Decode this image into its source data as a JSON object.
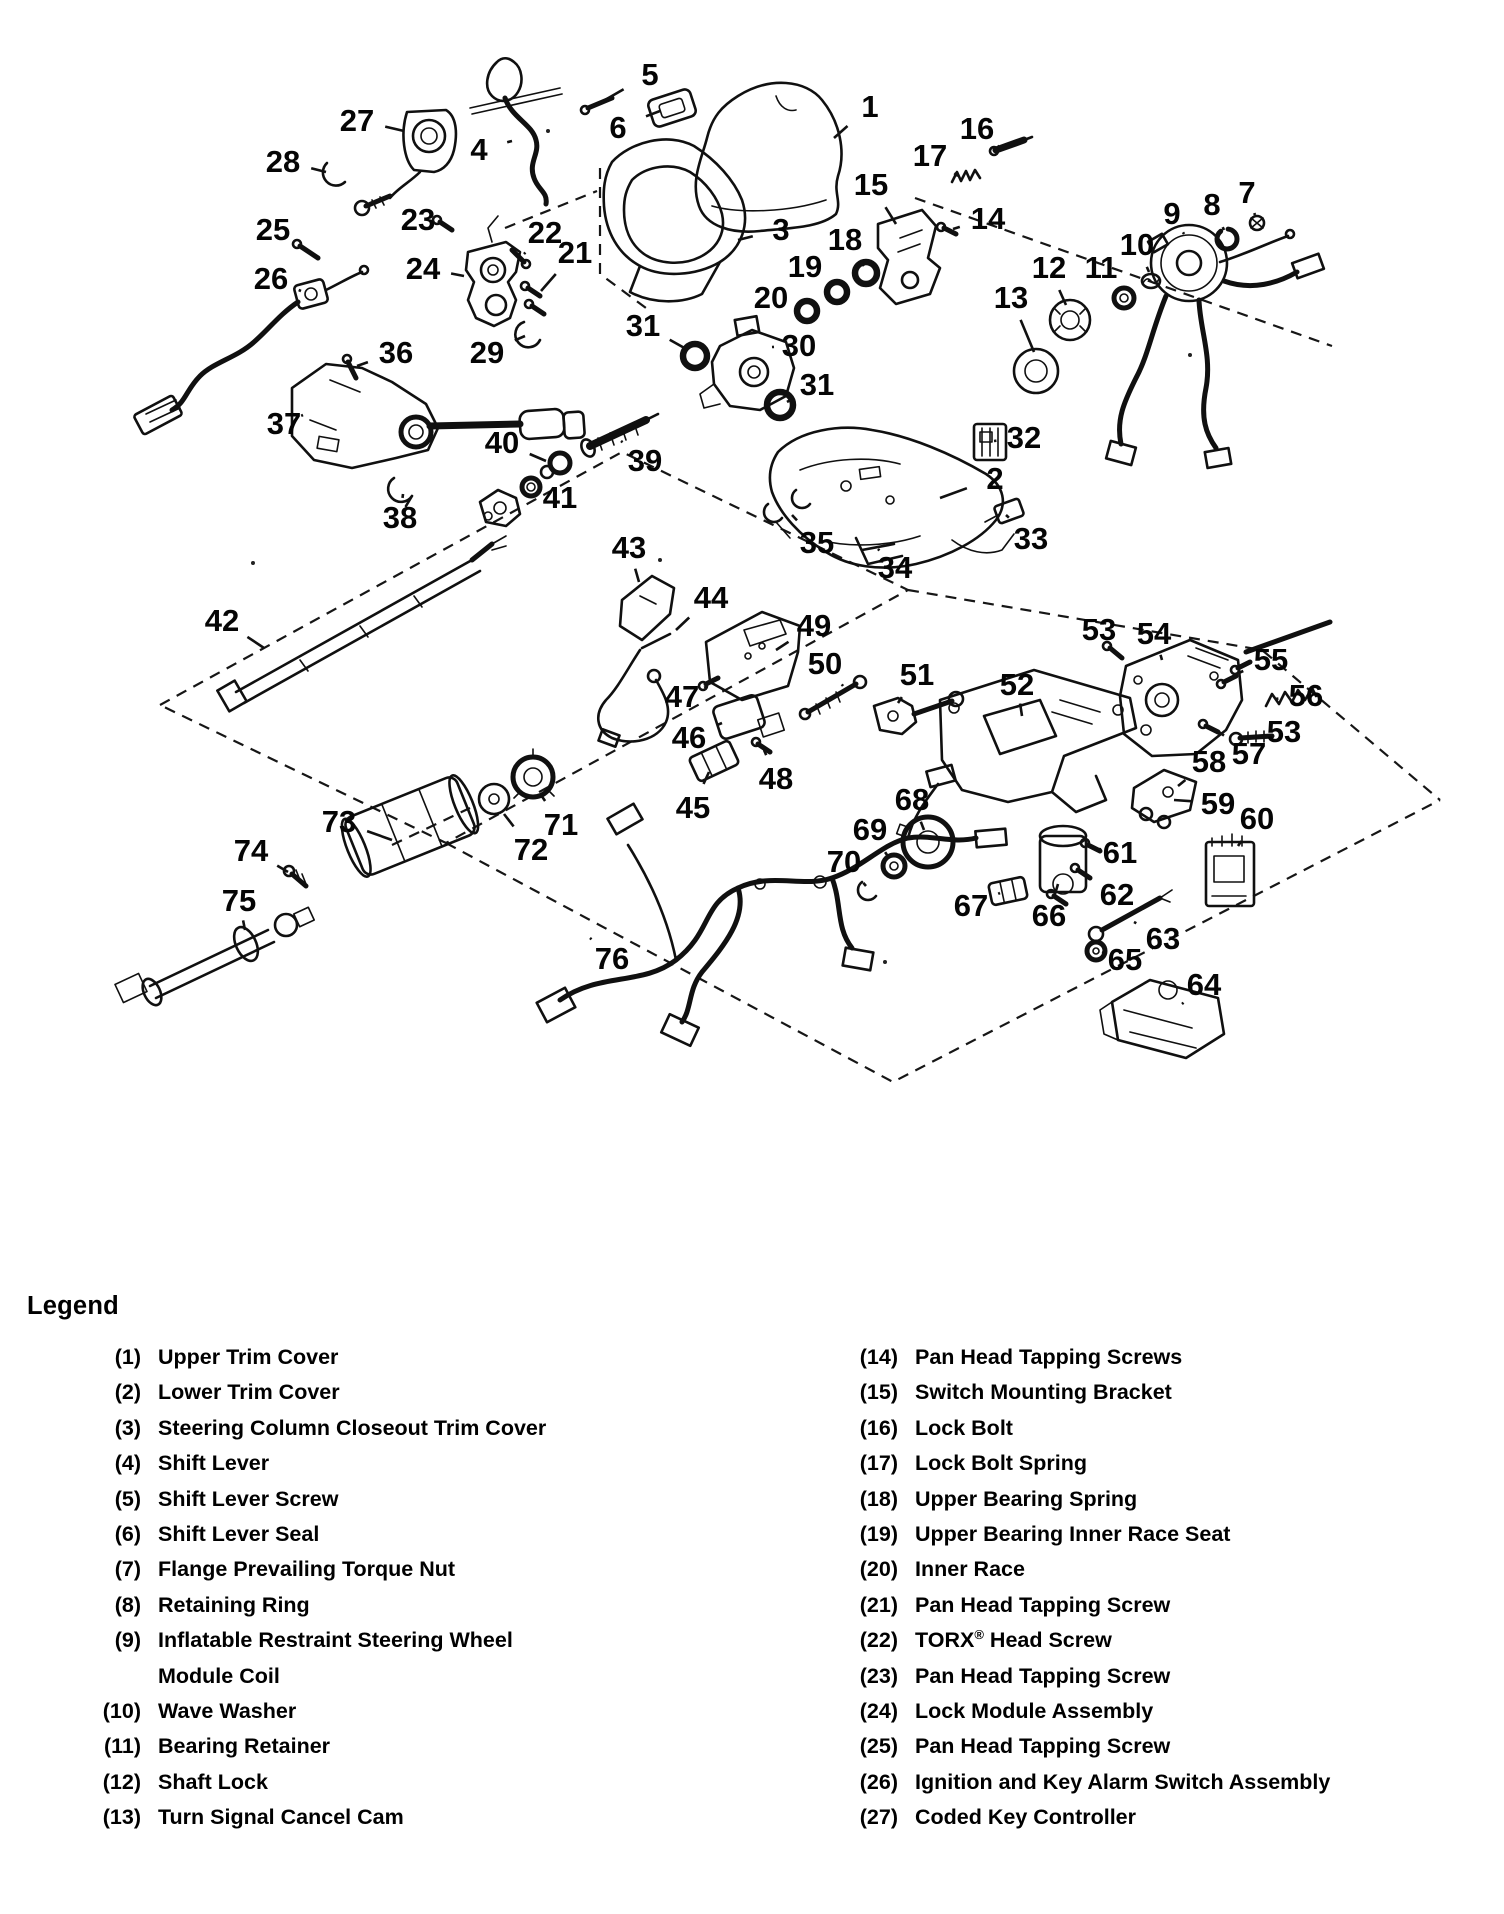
{
  "diagram": {
    "callouts": [
      {
        "n": "1",
        "x": 870,
        "y": 106,
        "tx": 834,
        "ty": 138
      },
      {
        "n": "2",
        "x": 995,
        "y": 478,
        "tx": 940,
        "ty": 498
      },
      {
        "n": "3",
        "x": 781,
        "y": 229,
        "tx": 738,
        "ty": 240
      },
      {
        "n": "4",
        "x": 479,
        "y": 149,
        "tx": 512,
        "ty": 141
      },
      {
        "n": "5",
        "x": 650,
        "y": 74,
        "tx": 598,
        "ty": 104
      },
      {
        "n": "6",
        "x": 618,
        "y": 127,
        "tx": 660,
        "ty": 111
      },
      {
        "n": "7",
        "x": 1247,
        "y": 192,
        "tx": 1255,
        "ty": 215
      },
      {
        "n": "8",
        "x": 1212,
        "y": 204,
        "tx": 1224,
        "ty": 230
      },
      {
        "n": "9",
        "x": 1172,
        "y": 213,
        "tx": 1184,
        "ty": 234
      },
      {
        "n": "10",
        "x": 1137,
        "y": 244,
        "tx": 1149,
        "ty": 272
      },
      {
        "n": "11",
        "x": 1101,
        "y": 267,
        "tx": 1119,
        "ty": 291
      },
      {
        "n": "12",
        "x": 1049,
        "y": 267,
        "tx": 1066,
        "ty": 305
      },
      {
        "n": "13",
        "x": 1011,
        "y": 297,
        "tx": 1034,
        "ty": 352
      },
      {
        "n": "14",
        "x": 988,
        "y": 218,
        "tx": 953,
        "ty": 229
      },
      {
        "n": "15",
        "x": 871,
        "y": 184,
        "tx": 896,
        "ty": 224
      },
      {
        "n": "16",
        "x": 977,
        "y": 128,
        "tx": 999,
        "ty": 147
      },
      {
        "n": "17",
        "x": 930,
        "y": 155,
        "tx": 958,
        "ty": 176
      },
      {
        "n": "18",
        "x": 845,
        "y": 239,
        "tx": 864,
        "ty": 266
      },
      {
        "n": "19",
        "x": 805,
        "y": 266,
        "tx": 833,
        "ty": 286
      },
      {
        "n": "20",
        "x": 771,
        "y": 297,
        "tx": 801,
        "ty": 308
      },
      {
        "n": "21",
        "x": 575,
        "y": 252,
        "tx": 541,
        "ty": 291
      },
      {
        "n": "22",
        "x": 545,
        "y": 232,
        "tx": 524,
        "ty": 254
      },
      {
        "n": "23",
        "x": 418,
        "y": 219,
        "tx": 444,
        "ty": 225
      },
      {
        "n": "24",
        "x": 423,
        "y": 268,
        "tx": 464,
        "ty": 276
      },
      {
        "n": "25",
        "x": 273,
        "y": 229,
        "tx": 303,
        "ty": 247
      },
      {
        "n": "26",
        "x": 271,
        "y": 278,
        "tx": 301,
        "ty": 291
      },
      {
        "n": "27",
        "x": 357,
        "y": 120,
        "tx": 404,
        "ty": 131
      },
      {
        "n": "28",
        "x": 283,
        "y": 161,
        "tx": 326,
        "ty": 172
      },
      {
        "n": "29",
        "x": 487,
        "y": 352,
        "tx": 525,
        "ty": 336
      },
      {
        "n": "30",
        "x": 799,
        "y": 345,
        "tx": 772,
        "ty": 347
      },
      {
        "n": "31",
        "x": 643,
        "y": 325,
        "tx": 688,
        "ty": 350
      },
      {
        "n": "31",
        "x": 817,
        "y": 384,
        "tx": 787,
        "ty": 402
      },
      {
        "n": "32",
        "x": 1024,
        "y": 437,
        "tx": 994,
        "ty": 441
      },
      {
        "n": "33",
        "x": 1031,
        "y": 538,
        "tx": 1006,
        "ty": 515
      },
      {
        "n": "34",
        "x": 895,
        "y": 567,
        "tx": 878,
        "ty": 549
      },
      {
        "n": "35",
        "x": 817,
        "y": 542,
        "tx": 792,
        "ty": 515
      },
      {
        "n": "36",
        "x": 396,
        "y": 352,
        "tx": 357,
        "ty": 366
      },
      {
        "n": "37",
        "x": 284,
        "y": 423,
        "tx": 303,
        "ty": 415
      },
      {
        "n": "38",
        "x": 400,
        "y": 517,
        "tx": 403,
        "ty": 494
      },
      {
        "n": "39",
        "x": 645,
        "y": 460,
        "tx": 621,
        "ty": 441
      },
      {
        "n": "40",
        "x": 502,
        "y": 442,
        "tx": 546,
        "ty": 461
      },
      {
        "n": "41",
        "x": 560,
        "y": 497,
        "tx": 538,
        "ty": 489
      },
      {
        "n": "42",
        "x": 222,
        "y": 620,
        "tx": 264,
        "ty": 648
      },
      {
        "n": "43",
        "x": 629,
        "y": 547,
        "tx": 639,
        "ty": 582
      },
      {
        "n": "44",
        "x": 711,
        "y": 597,
        "tx": 676,
        "ty": 630
      },
      {
        "n": "45",
        "x": 693,
        "y": 807,
        "tx": 709,
        "ty": 772
      },
      {
        "n": "46",
        "x": 689,
        "y": 737,
        "tx": 722,
        "ty": 723
      },
      {
        "n": "47",
        "x": 682,
        "y": 696,
        "tx": 706,
        "ty": 687
      },
      {
        "n": "48",
        "x": 776,
        "y": 778,
        "tx": 764,
        "ty": 750
      },
      {
        "n": "49",
        "x": 814,
        "y": 625,
        "tx": 776,
        "ty": 650
      },
      {
        "n": "50",
        "x": 825,
        "y": 663,
        "tx": 843,
        "ty": 686
      },
      {
        "n": "51",
        "x": 917,
        "y": 674,
        "tx": 898,
        "ty": 703
      },
      {
        "n": "52",
        "x": 1017,
        "y": 684,
        "tx": 1022,
        "ty": 716
      },
      {
        "n": "53",
        "x": 1099,
        "y": 629,
        "tx": 1112,
        "ty": 650
      },
      {
        "n": "53",
        "x": 1284,
        "y": 731,
        "tx": 1250,
        "ty": 737
      },
      {
        "n": "54",
        "x": 1154,
        "y": 633,
        "tx": 1162,
        "ty": 660
      },
      {
        "n": "55",
        "x": 1271,
        "y": 659,
        "tx": 1234,
        "ty": 675
      },
      {
        "n": "56",
        "x": 1306,
        "y": 695,
        "tx": 1275,
        "ty": 699
      },
      {
        "n": "57",
        "x": 1249,
        "y": 753,
        "tx": 1216,
        "ty": 730
      },
      {
        "n": "58",
        "x": 1209,
        "y": 761,
        "tx": 1178,
        "ty": 786
      },
      {
        "n": "59",
        "x": 1218,
        "y": 803,
        "tx": 1174,
        "ty": 800
      },
      {
        "n": "60",
        "x": 1257,
        "y": 818,
        "tx": 1238,
        "ty": 846
      },
      {
        "n": "61",
        "x": 1120,
        "y": 852,
        "tx": 1099,
        "ty": 849
      },
      {
        "n": "62",
        "x": 1117,
        "y": 894,
        "tx": 1088,
        "ty": 876
      },
      {
        "n": "63",
        "x": 1163,
        "y": 938,
        "tx": 1134,
        "ty": 922
      },
      {
        "n": "64",
        "x": 1204,
        "y": 984,
        "tx": 1182,
        "ty": 1004
      },
      {
        "n": "65",
        "x": 1125,
        "y": 959,
        "tx": 1102,
        "ty": 952
      },
      {
        "n": "66",
        "x": 1049,
        "y": 915,
        "tx": 1058,
        "ty": 884
      },
      {
        "n": "67",
        "x": 971,
        "y": 905,
        "tx": 1000,
        "ty": 893
      },
      {
        "n": "68",
        "x": 912,
        "y": 799,
        "tx": 924,
        "ty": 830
      },
      {
        "n": "69",
        "x": 870,
        "y": 829,
        "tx": 889,
        "ty": 858
      },
      {
        "n": "70",
        "x": 844,
        "y": 861,
        "tx": 866,
        "ty": 886
      },
      {
        "n": "71",
        "x": 561,
        "y": 824,
        "tx": 541,
        "ty": 795
      },
      {
        "n": "72",
        "x": 531,
        "y": 849,
        "tx": 504,
        "ty": 814
      },
      {
        "n": "73",
        "x": 339,
        "y": 821,
        "tx": 392,
        "ty": 840
      },
      {
        "n": "74",
        "x": 251,
        "y": 850,
        "tx": 288,
        "ty": 872
      },
      {
        "n": "75",
        "x": 239,
        "y": 900,
        "tx": 245,
        "ty": 930
      },
      {
        "n": "76",
        "x": 612,
        "y": 958,
        "tx": 590,
        "ty": 938
      }
    ]
  },
  "legend": {
    "heading": "Legend",
    "columns": [
      {
        "items": [
          {
            "num": "(1)",
            "label": "Upper Trim Cover"
          },
          {
            "num": "(2)",
            "label": "Lower Trim Cover"
          },
          {
            "num": "(3)",
            "label": "Steering Column Closeout Trim Cover"
          },
          {
            "num": "(4)",
            "label": "Shift Lever"
          },
          {
            "num": "(5)",
            "label": "Shift Lever Screw"
          },
          {
            "num": "(6)",
            "label": "Shift Lever Seal"
          },
          {
            "num": "(7)",
            "label": "Flange Prevailing Torque Nut"
          },
          {
            "num": "(8)",
            "label": "Retaining Ring"
          },
          {
            "num": "(9)",
            "label": "Inflatable Restraint Steering Wheel",
            "label2": "Module Coil"
          },
          {
            "num": "(10)",
            "label": "Wave Washer"
          },
          {
            "num": "(11)",
            "label": "Bearing Retainer"
          },
          {
            "num": "(12)",
            "label": "Shaft Lock"
          },
          {
            "num": "(13)",
            "label": "Turn Signal Cancel Cam"
          }
        ]
      },
      {
        "items": [
          {
            "num": "(14)",
            "label": "Pan Head Tapping Screws"
          },
          {
            "num": "(15)",
            "label": "Switch Mounting Bracket"
          },
          {
            "num": "(16)",
            "label": "Lock Bolt"
          },
          {
            "num": "(17)",
            "label": "Lock Bolt Spring"
          },
          {
            "num": "(18)",
            "label": "Upper Bearing Spring"
          },
          {
            "num": "(19)",
            "label": "Upper Bearing Inner Race Seat"
          },
          {
            "num": "(20)",
            "label": "Inner Race"
          },
          {
            "num": "(21)",
            "label": "Pan Head Tapping Screw"
          },
          {
            "num": "(22)",
            "label": "TORX® Head Screw"
          },
          {
            "num": "(23)",
            "label": "Pan Head Tapping Screw"
          },
          {
            "num": "(24)",
            "label": "Lock Module Assembly"
          },
          {
            "num": "(25)",
            "label": "Pan Head Tapping Screw"
          },
          {
            "num": "(26)",
            "label": "Ignition and Key Alarm Switch Assembly"
          },
          {
            "num": "(27)",
            "label": "Coded Key Controller"
          }
        ]
      }
    ]
  }
}
